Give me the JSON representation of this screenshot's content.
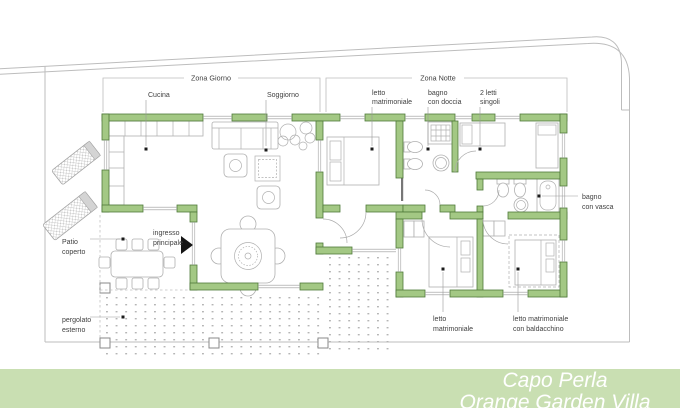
{
  "slide": {
    "banner": {
      "title": "Capo Perla",
      "subtitle": "Orange Garden Villa"
    },
    "zones": {
      "day": "Zona Giorno",
      "night": "Zona Notte"
    },
    "rooms": {
      "cucina": "Cucina",
      "soggiorno": "Soggiorno",
      "letto_top": {
        "l1": "letto",
        "l2": "matrimoniale"
      },
      "bagno_doccia": {
        "l1": "bagno",
        "l2": "con doccia"
      },
      "letti_singoli": {
        "l1": "2 letti",
        "l2": "singoli"
      },
      "bagno_vasca": {
        "l1": "bagno",
        "l2": "con vasca"
      },
      "patio": {
        "l1": "Patio",
        "l2": "coperto"
      },
      "ingresso": {
        "l1": "ingresso",
        "l2": "principale"
      },
      "pergolato": {
        "l1": "pergolato",
        "l2": "esterno"
      },
      "letto_bottom": {
        "l1": "letto",
        "l2": "matrimoniale"
      },
      "letto_baldacchino": {
        "l1": "letto matrimoniale",
        "l2": "con baldacchino"
      }
    },
    "colors": {
      "wall": "#a3c884",
      "wall_border": "#4f7a3a",
      "banner_bg": "#c9dfb2",
      "banner_text": "#ffffff",
      "boundary": "#bdbdbd",
      "furniture": "#b0b0b0",
      "label_text": "#3f3f3f"
    }
  }
}
